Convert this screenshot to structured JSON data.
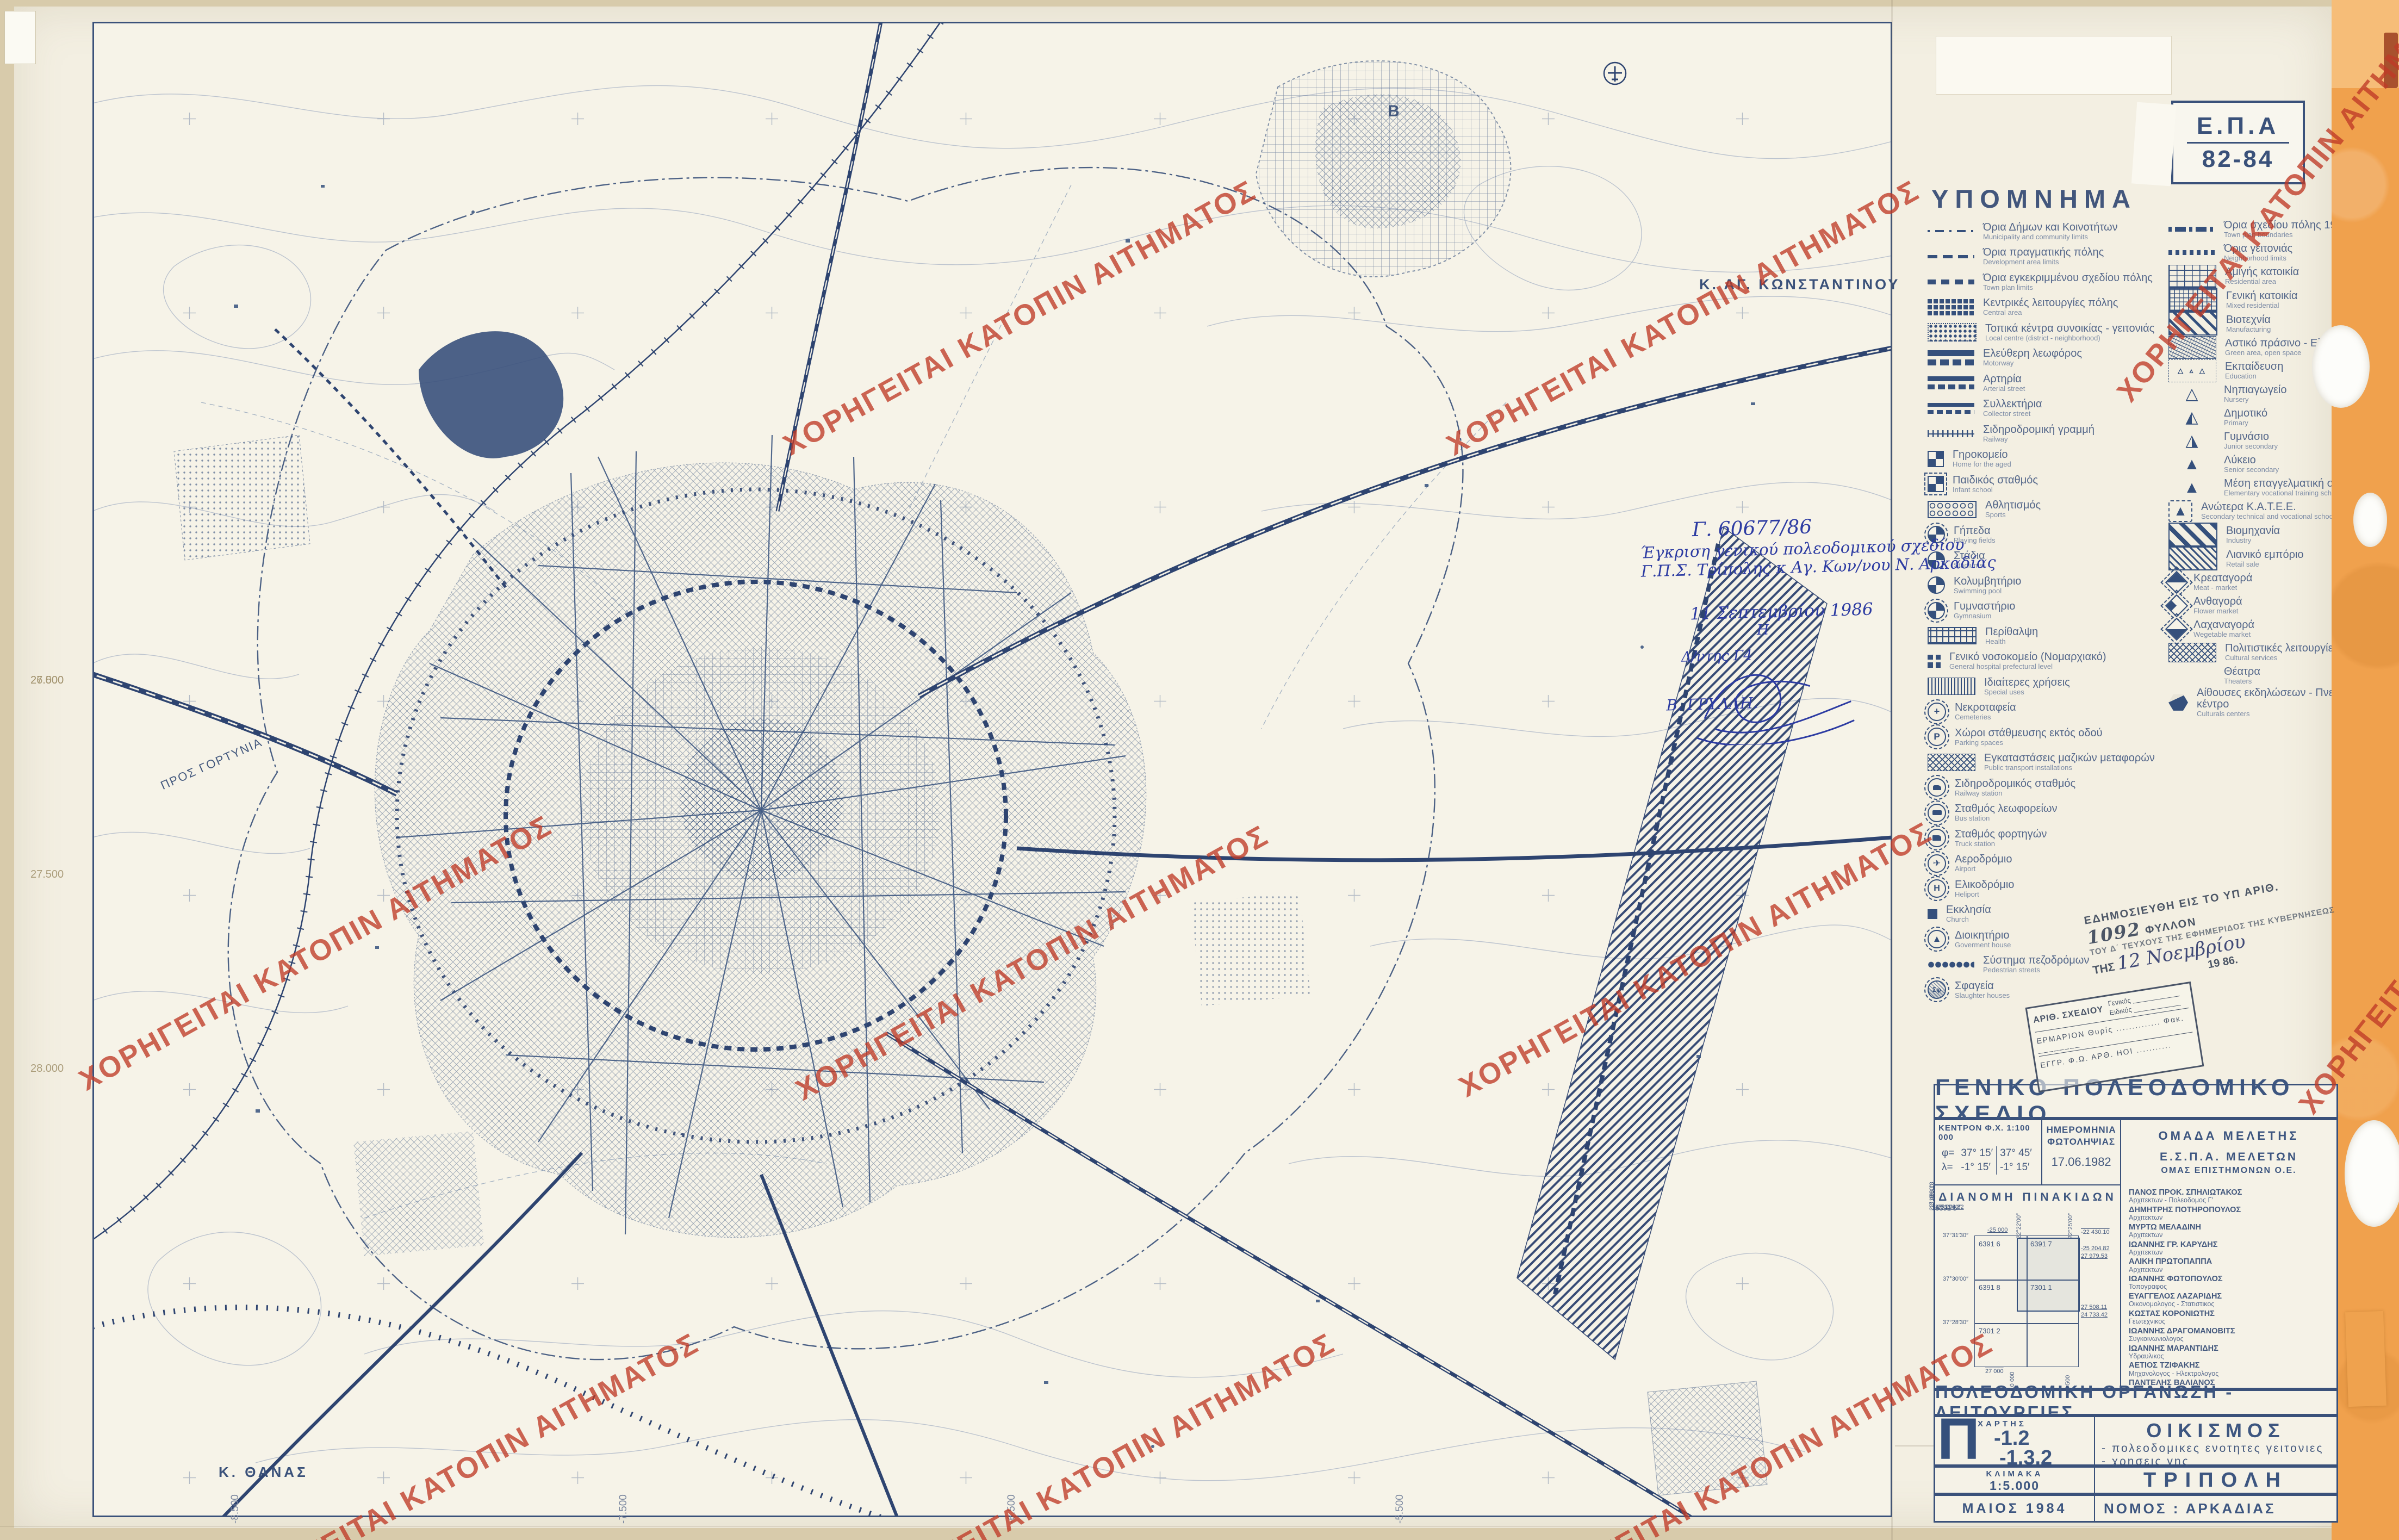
{
  "watermark": {
    "text": "ΧΟΡΗΓΕΙΤΑΙ ΚΑΤΟΠΙΝ ΑΙΤΗΜΑΤΟΣ",
    "color": "#bf3a26"
  },
  "epa_box": {
    "top": "Ε.Π.Α",
    "bottom": "82-84"
  },
  "map": {
    "label_ag_konstantinou": "Κ. ΑΓ. ΚΩΝΣΤΑΝΤΙΝΟΥ",
    "label_thanas": "Κ. ΘΑΝΑΣ",
    "label_pros_gortynia": "ΠΡΟΣ ΓΟΡΤΥΝΙΑ",
    "label_b": "B",
    "edge_labels_left": [
      "26.500",
      "27.000",
      "27.500",
      "28.000"
    ],
    "edge_labels_bottom": [
      "-9.500",
      "-8.500",
      "-7.500",
      "-6.500",
      "-5.500"
    ]
  },
  "legend": {
    "title": "ΥΠΟΜΝΗΜΑ",
    "left": [
      {
        "gr": "Όρια Δήμων και Κοινοτήτων",
        "en": "Municipality and community limits",
        "sym": "dashdot-thin"
      },
      {
        "gr": "Όρια πραγματικής πόλης",
        "en": "Development area limits",
        "sym": "dash-med"
      },
      {
        "gr": "Όρια εγκεκριμμένου σχεδίου πόλης",
        "en": "Town plan limits",
        "sym": "dash-bold"
      },
      {
        "gr": "Κεντρικές λειτουργίες πόλης",
        "en": "Central area",
        "sym": "blocks-dark"
      },
      {
        "gr": "Τοπικά κέντρα συνοικίας - γειτονιάς",
        "en": "Local centre (district - neighborhood)",
        "sym": "blocks-dotted"
      },
      {
        "gr": "Ελεύθερη λεωφόρος",
        "en": "Motorway",
        "sym": "bar-solid"
      },
      {
        "gr": "Αρτηρία",
        "en": "Arterial street",
        "sym": "bar-dash"
      },
      {
        "gr": "Συλλεκτήρια",
        "en": "Collector street",
        "sym": "bar-thin-dash"
      },
      {
        "gr": "Σιδηροδρομική γραμμή",
        "en": "Railway",
        "sym": "rail"
      },
      {
        "gr": "Γηροκομείο",
        "en": "Home for the aged",
        "sym": "sq-quarters"
      },
      {
        "gr": "Παιδικός σταθμός",
        "en": "Infant school",
        "sym": "sq-quarters-dash"
      },
      {
        "gr": "Αθλητισμός",
        "en": "Sports",
        "sym": "rect-circles"
      },
      {
        "gr": "Γήπεδα",
        "en": "Playing fields",
        "sym": "circ-quarters"
      },
      {
        "gr": "Στάδια",
        "en": "Stadiums",
        "sym": "circ-quarters-solid"
      },
      {
        "gr": "Κολυμβητήριο",
        "en": "Swimming pool",
        "sym": "circ-quarters-solid"
      },
      {
        "gr": "Γυμναστήριο",
        "en": "Gymnasium",
        "sym": "circ-quarters"
      },
      {
        "gr": "Περίθαλψη",
        "en": "Health",
        "sym": "rect-plus"
      },
      {
        "gr": "Γενικό νοσοκομείο (Νομαρχιακό)",
        "en": "General hospital prefectural level",
        "sym": "cross-sq"
      },
      {
        "gr": "Ιδιαίτερες χρήσεις",
        "en": "Special uses",
        "sym": "rect-vlines"
      },
      {
        "gr": "Νεκροταφεία",
        "en": "Cemeteries",
        "sym": "circ-cross",
        "glyph": "+"
      },
      {
        "gr": "Χώροι στάθμευσης εκτός οδού",
        "en": "Parking spaces",
        "sym": "circ-p",
        "glyph": "P"
      },
      {
        "gr": "Εγκαταστάσεις μαζικών μεταφορών",
        "en": "Public transport installations",
        "sym": "rect-mesh"
      },
      {
        "gr": "Σιδηροδρομικός σταθμός",
        "en": "Railway station",
        "sym": "circ-train"
      },
      {
        "gr": "Σταθμός λεωφορείων",
        "en": "Bus station",
        "sym": "circ-bus"
      },
      {
        "gr": "Σταθμός φορτηγών",
        "en": "Truck station",
        "sym": "circ-truck"
      },
      {
        "gr": "Αεροδρόμιο",
        "en": "Airport",
        "sym": "circ-plane",
        "glyph": "✈"
      },
      {
        "gr": "Ελικοδρόμιο",
        "en": "Heliport",
        "sym": "circ-heli",
        "glyph": "H"
      },
      {
        "gr": "Εκκλησία",
        "en": "Church",
        "sym": "sq-solid"
      },
      {
        "gr": "Διοικητήριο",
        "en": "Goverment house",
        "sym": "circ-tri",
        "glyph": "▲"
      },
      {
        "gr": "Σύστημα πεζοδρόμων",
        "en": "Pedestrian streets",
        "sym": "dots-row"
      },
      {
        "gr": "Σφαγεία",
        "en": "Slaughter houses",
        "sym": "circ-sf",
        "glyph": "Σφ"
      }
    ],
    "right": [
      {
        "gr": "Όρια σχεδίου πόλης 1987",
        "en": "Town plan boundaries",
        "sym": "dashdot-bold"
      },
      {
        "gr": "Όρια γειτονιάς",
        "en": "Neighborhood limits",
        "sym": "dots-bold"
      },
      {
        "gr": "Αμιγής κατοικία",
        "en": "Residential area",
        "sym": "grid-sparse"
      },
      {
        "gr": "Γενική κατοικία",
        "en": "Mixed residential",
        "sym": "grid-dense"
      },
      {
        "gr": "Βιοτεχνία",
        "en": "Manufacturing",
        "sym": "hatch"
      },
      {
        "gr": "Αστικό πράσινο - Ελεύθεροι χώροι",
        "en": "Green area, open space",
        "sym": "scribble"
      },
      {
        "gr": "Εκπαίδευση",
        "en": "Education",
        "sym": "tri-field",
        "glyph": "△ ▵ △"
      },
      {
        "gr": "Νηπιαγωγείο",
        "en": "Nursery",
        "sym": "tri-open",
        "glyph": "△"
      },
      {
        "gr": "Δημοτικό",
        "en": "Primary",
        "sym": "tri-half",
        "glyph": "◭"
      },
      {
        "gr": "Γυμνάσιο",
        "en": "Junior secondary",
        "sym": "tri-right",
        "glyph": "◮"
      },
      {
        "gr": "Λύκειο",
        "en": "Senior secondary",
        "sym": "tri-filled",
        "glyph": "▲"
      },
      {
        "gr": "Μέση επαγγελματική σχολή",
        "en": "Elementary vocational training school",
        "sym": "tri-filled",
        "glyph": "▲"
      },
      {
        "gr": "Ανώτερα Κ.Α.Τ.Ε.Ε.",
        "en": "Secondary technical and vocational school",
        "sym": "tri-in-dash",
        "glyph": "▲"
      },
      {
        "gr": "Βιομηχανία",
        "en": "Industry",
        "sym": "hatch-bold"
      },
      {
        "gr": "Λιανικό εμπόριο",
        "en": "Retail sale",
        "sym": "hatch-fine"
      },
      {
        "gr": "Κρεαταγορά",
        "en": "Meat - market",
        "sym": "dia-left"
      },
      {
        "gr": "Ανθαγορά",
        "en": "Flower market",
        "sym": "dia-quarter"
      },
      {
        "gr": "Λαχαναγορά",
        "en": "Wegetable market",
        "sym": "dia-bottom"
      },
      {
        "gr": "Πολιτιστικές λειτουργίες",
        "en": "Cultural services",
        "sym": "mesh-small"
      },
      {
        "gr": "Θέατρα",
        "en": "Theaters",
        "sym": "blank"
      },
      {
        "gr": "Αίθουσες εκδηλώσεων - Πνευματικό κέντρο",
        "en": "Culturals centers",
        "sym": "hex-3d"
      }
    ]
  },
  "approval_note": {
    "l1": "Γ. 60677/86",
    "l2": "Έγκριση γενικού πολεοδομικού σχεδίου",
    "l3": "Γ.Π.Σ. Τρίπολης κ Αγ. Κων/νου Ν. Αρκαδίας",
    "l4": "11 Σεπτεμβρίου 1986",
    "l5": "Η",
    "l6": "Δ/ντης Γ4",
    "l7": "Β. ΓΡΥΛΛΗ."
  },
  "publication_stamp": {
    "l1": "ΕΔΗΜΟΣΙΕΥΘΗ ΕΙΣ ΤΟ ΥΠ ΑΡΙΘ.",
    "no": "1092",
    "l1c": "ΦΥΛΛΟΝ",
    "l2": "ΤΟΥ Δ΄ ΤΕΥΧΟΥΣ ΤΗΣ ΕΦΗΜΕΡΙΔΟΣ ΤΗΣ ΚΥΒΕΡΝΗΣΕΩΣ",
    "pre": "ΤΗΣ",
    "date_script": "12 Νοεμβρίου",
    "year": "19 86."
  },
  "drawing_stamp": {
    "t1": "ΑΡΙΘ. ΣΧΕΔΙΟΥ",
    "g": "Γενικός ____________",
    "e": "Ειδικός ____________",
    "r2": "ΕΡΜΑΡΙΟΝ  Θυρίς ..............  Φακ. ________",
    "r3": "ΕΓΓΡ.  Φ.Ω.    ΑΡΘ.  ΗΟΙ ..........."
  },
  "title_block": {
    "header": "ΓΕΝΙΚΟ  ΠΟΛΕΟΔΟΜΙΚΟ  ΣΧΕΔΙΟ",
    "center": {
      "label": "ΚΕΝΤΡΟΝ  Φ.Χ.  1:100 000",
      "phi": "φ=",
      "lambda": "λ=",
      "r1a": "37° 15′",
      "r1b": "37° 45′",
      "r2a": "-1° 15′",
      "r2b": "-1° 15′"
    },
    "photo": {
      "l1": "ΗΜΕΡΟΜΗΝΙΑ",
      "l2": "ΦΩΤΟΛΗΨΙΑΣ",
      "date": "17.06.1982"
    },
    "team": {
      "l1": "ΟΜΑΔΑ  ΜΕΛΕΤΗΣ",
      "l2": "Ε.Σ.Π.Α.  ΜΕΛΕΤΩΝ",
      "l3": "ΟΜΑΣ ΕΠΙΣΤΗΜΟΝΩΝ Ο.Ε.",
      "members": [
        {
          "name": "ΠΑΝΟΣ ΠΡΟΚ. ΣΠΗΛΙΩΤΑΚΟΣ",
          "role": "Αρχιτεκτων - Πολεοδομος Γ′"
        },
        {
          "name": "ΔΗΜΗΤΡΗΣ ΠΟΤΗΡΟΠΟΥΛΟΣ",
          "role": "Αρχιτεκτων"
        },
        {
          "name": "ΜΥΡΤΩ ΜΕΛΑΔΙΝΗ",
          "role": "Αρχιτεκτων"
        },
        {
          "name": "ΙΩΑΝΝΗΣ ΓΡ. ΚΑΡΥΔΗΣ",
          "role": "Αρχιτεκτων"
        },
        {
          "name": "ΑΛΙΚΗ ΠΡΩΤΟΠΑΠΠΑ",
          "role": "Αρχιτεκτων"
        },
        {
          "name": "ΙΩΑΝΝΗΣ ΦΩΤΟΠΟΥΛΟΣ",
          "role": "Τοπογραφος"
        },
        {
          "name": "ΕΥΑΓΓΕΛΟΣ ΛΑΖΑΡΙΔΗΣ",
          "role": "Οικονομολογος - Στατιστικος"
        },
        {
          "name": "ΚΩΣΤΑΣ ΚΟΡΟΝΙΩΤΗΣ",
          "role": "Γεωτεχνικος"
        },
        {
          "name": "ΙΩΑΝΝΗΣ ΔΡΑΓΟΜΑΝΟΒΙΤΣ",
          "role": "Συγκοινωνιολογος"
        },
        {
          "name": "ΙΩΑΝΝΗΣ ΜΑΡΑΝΤΙΔΗΣ",
          "role": "Υδραυλικος"
        },
        {
          "name": "ΑΕΤΙΟΣ ΤΖΙΦΑΚΗΣ",
          "role": "Μηχανολογος - Ηλεκτρολογος"
        },
        {
          "name": "ΠΑΝΤΕΛΗΣ ΒΑΛΙΑΝΟΣ",
          "role": "Μηχανολογος - Ηλεκτρολογος"
        },
        {
          "name": "ΣΤΑΜΑΤΗΣ ΣΕΚΛΙΖΙΩΤΗΣ",
          "role": "Περιβαλλοντολογος - Οικολογος"
        }
      ],
      "address": "ΡΑΒΙΝΕ 24  ΑΘΗΝΑ  τηλ.: 72.27.012"
    },
    "sheet_index": {
      "title": "ΔΙΑΝΟΜΗ  ΠΙΝΑΚΙΔΩΝ",
      "sheets": [
        "6391 5",
        "6391 6",
        "6391 7",
        "6391 8",
        "7301 1",
        "7301 2"
      ],
      "top_coords": [
        "22°19′00″",
        "22°22′00″",
        "22°25′00″"
      ],
      "left_coords": [
        "37°33′00″",
        "37°31′30″",
        "37°30′00″",
        "37°28′30″"
      ],
      "n_top": "-25 000",
      "n_topright": "-22 430.10",
      "n_right": [
        "-25 204.82",
        "-25 204.82",
        "27 979.53",
        "27 508.11",
        "24 733.42"
      ],
      "n_bottom": [
        "-13 488.18",
        "-9 065.33",
        "-9 065.33",
        "-4 642.48"
      ],
      "n_27000": "27 000",
      "n_10000": "-10 000",
      "n_5500": "-5 500"
    },
    "section2": "ΠΟΛΕΟΔΟΜΙΚΗ  ΟΡΓΑΝΩΣΗ - ΛΕΙΤΟΥΡΓΙΕΣ",
    "map_no": {
      "label": "ΧΑΡΤΗΣ",
      "big": "Π",
      "n1": "-1.2",
      "n2": "-1.3.2"
    },
    "subject": {
      "title": "ΟΙΚΙΣΜΟΣ",
      "b1": "- πολεοδομικες ενοτητες γειτονιες",
      "b2": "- χρησεις γης"
    },
    "scale": {
      "label": "ΚΛΙΜΑΚΑ",
      "value": "1:5.000"
    },
    "city": "ΤΡΙΠΟΛΗ",
    "date": "ΜΑΙΟΣ 1984",
    "prefecture": "ΝΟΜΟΣ :  ΑΡΚΑΔΙΑΣ"
  }
}
